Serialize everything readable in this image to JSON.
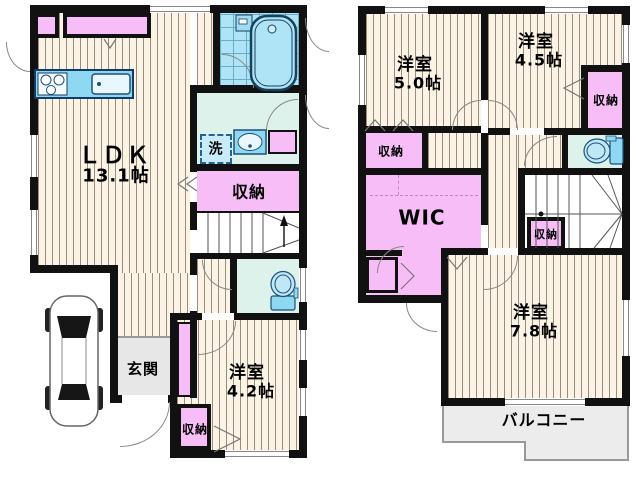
{
  "floor1": {
    "ldk": {
      "name": "ＬＤＫ",
      "size": "13.1帖"
    },
    "laundry": {
      "label": "洗"
    },
    "storage_mid": {
      "label": "収納"
    },
    "entrance": {
      "label": "玄関"
    },
    "bedroom42": {
      "name": "洋室",
      "size": "4.2帖"
    },
    "storage_bottom": {
      "label": "収納"
    }
  },
  "floor2": {
    "bedroom50": {
      "name": "洋室",
      "size": "5.0帖"
    },
    "bedroom45": {
      "name": "洋室",
      "size": "4.5帖"
    },
    "storage_right": {
      "label": "収納"
    },
    "storage_left": {
      "label": "収納"
    },
    "wic": {
      "label": "WIC"
    },
    "storage_under_stairs": {
      "label": "収納"
    },
    "bedroom78": {
      "name": "洋室",
      "size": "7.8帖"
    },
    "balcony": {
      "label": "バルコニー"
    }
  },
  "colors": {
    "wall": "#111111",
    "flooring": "#faf3e6",
    "closet_pink": "#f7bdf7",
    "wet_area": "#def2ec",
    "bath_blue": "#aee4f5",
    "fixture_blue": "#8fd8f2",
    "entrance_gray": "#e7e7e7",
    "balcony_gray": "#ececec"
  }
}
